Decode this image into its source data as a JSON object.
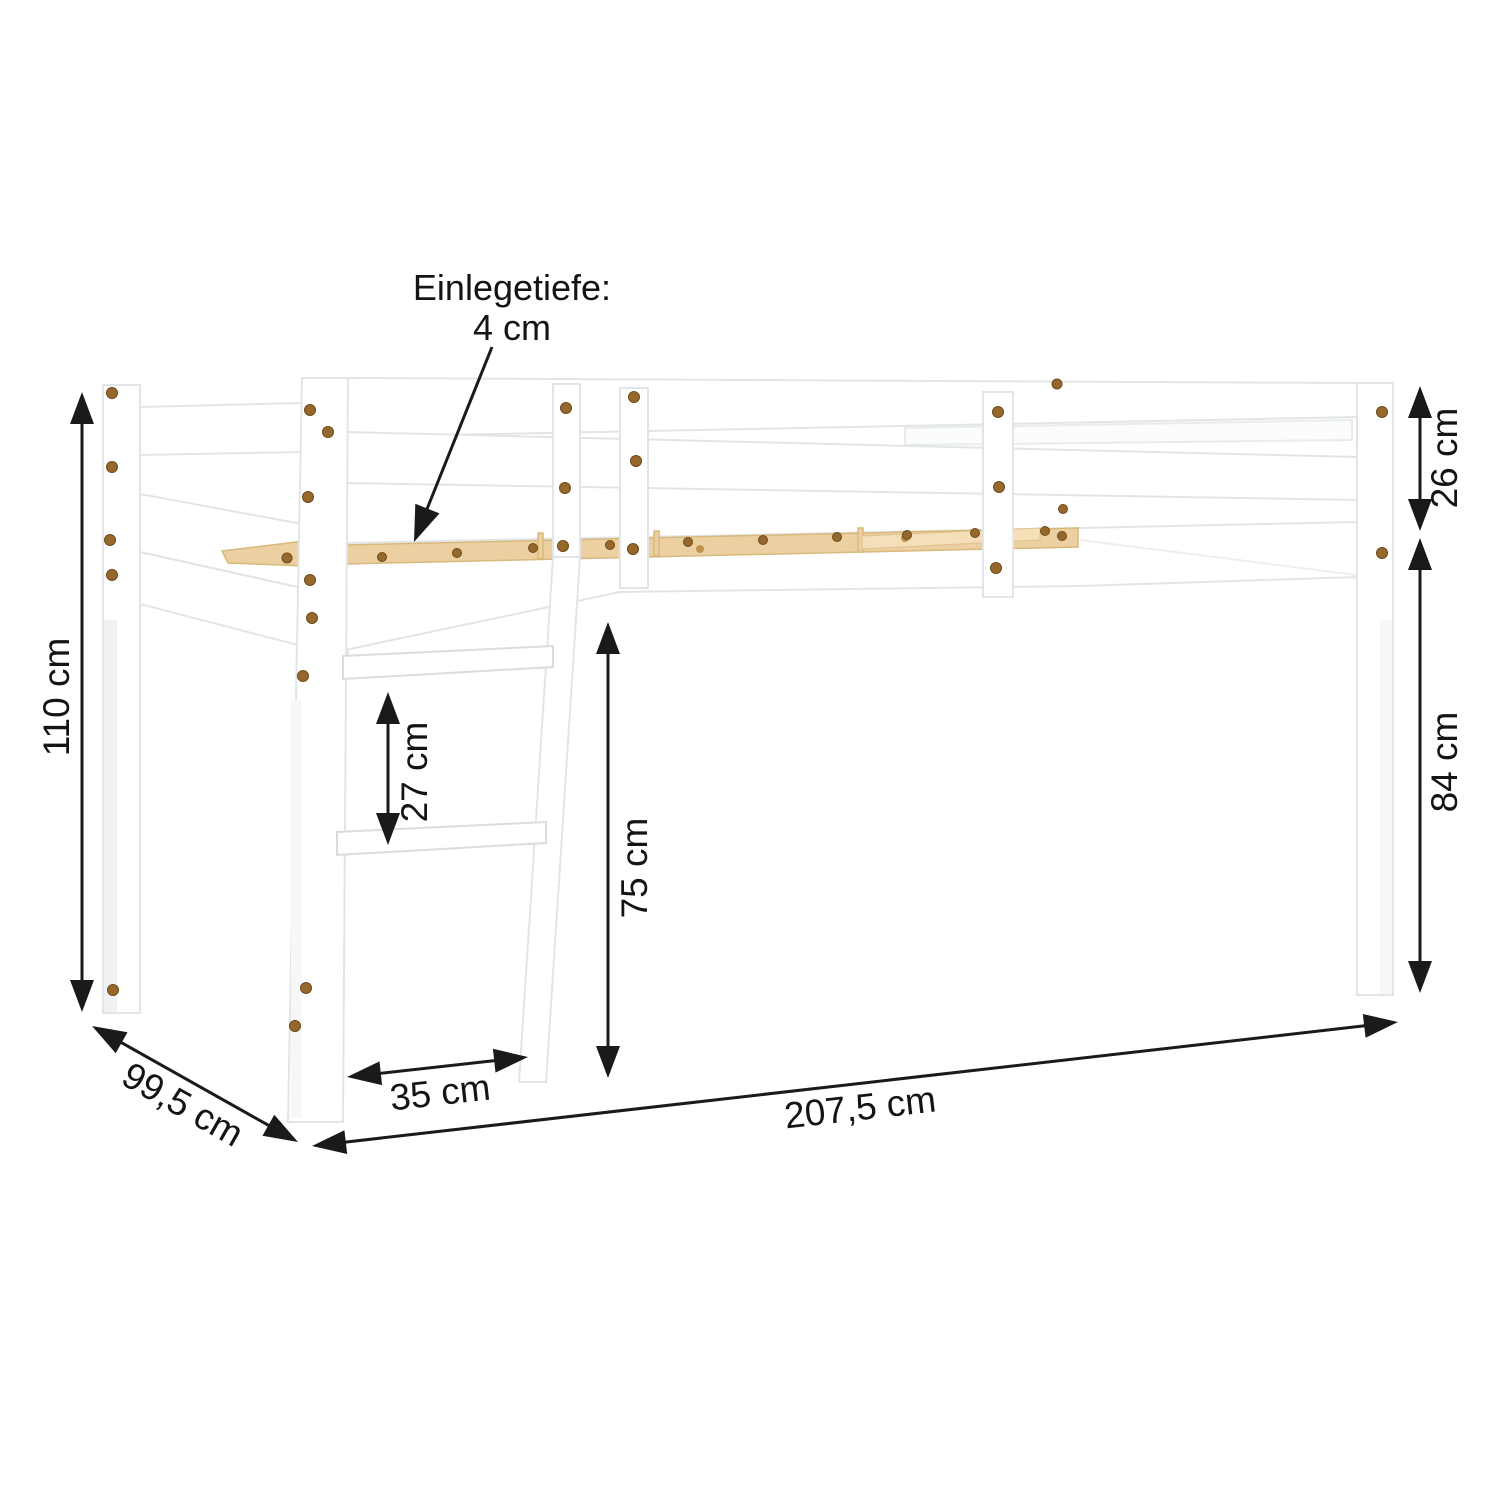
{
  "annotations": {
    "insert_depth_line1": "Einlegetiefe:",
    "insert_depth_line2": "4 cm",
    "total_height": "110 cm",
    "depth": "99,5 cm",
    "ladder_rung_spacing": "27 cm",
    "ladder_width": "35 cm",
    "under_clearance": "75 cm",
    "total_length": "207,5 cm",
    "guard_rail_height": "26 cm",
    "leg_height": "84 cm"
  },
  "colors": {
    "background": "#ffffff",
    "bed_outline": "#e2e5e7",
    "wood_slat": "#ecd0a2",
    "screw": "#96682c",
    "dimension": "#1a1a1a"
  }
}
